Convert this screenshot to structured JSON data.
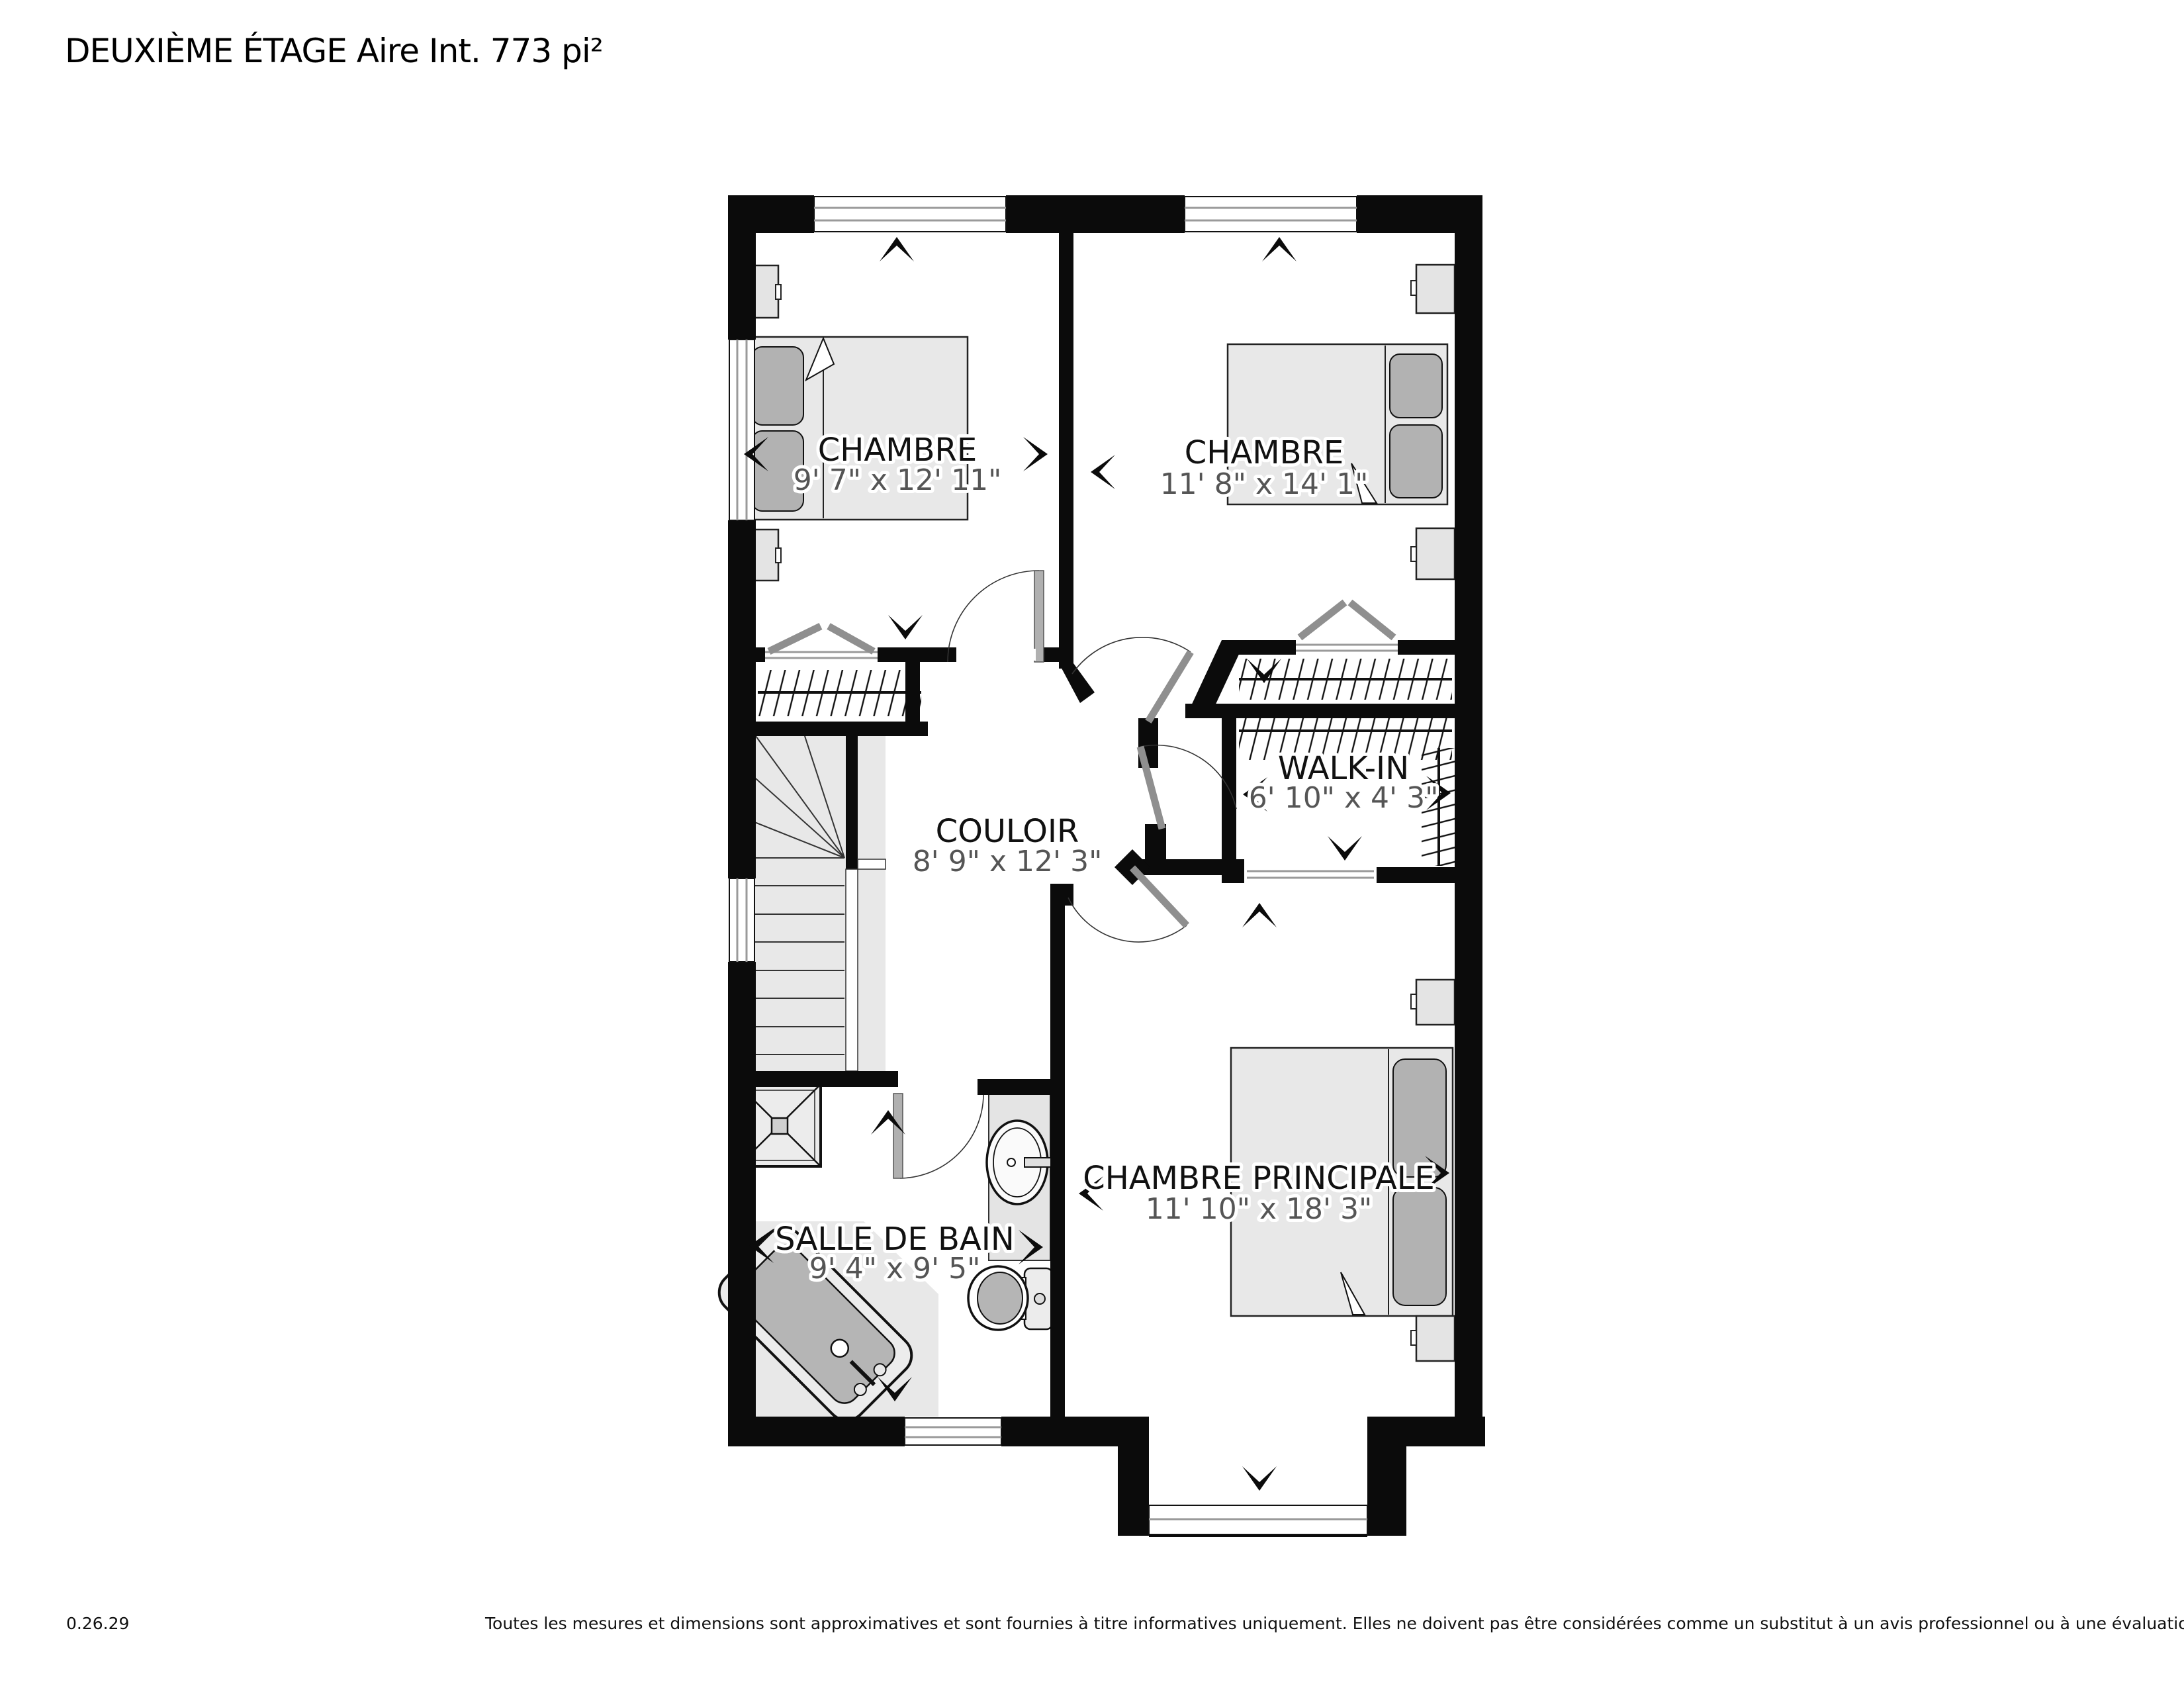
{
  "title": "DEUXIÈME ÉTAGE Aire Int. 773 pi²",
  "rooms": [
    {
      "id": "bedroom-1",
      "name": "CHAMBRE",
      "dims": "9' 7\" x 12' 11\""
    },
    {
      "id": "bedroom-2",
      "name": "CHAMBRE",
      "dims": "11' 8\" x 14' 1\""
    },
    {
      "id": "walk-in",
      "name": "WALK-IN",
      "dims": "6' 10\" x 4' 3\""
    },
    {
      "id": "couloir",
      "name": "COULOIR",
      "dims": "8' 9\" x 12' 3\""
    },
    {
      "id": "master-bedroom",
      "name": "CHAMBRE PRINCIPALE",
      "dims": "11' 10\" x 18' 3\""
    },
    {
      "id": "bathroom",
      "name": "SALLE DE BAIN",
      "dims": "9' 4\" x 9' 5\""
    }
  ],
  "footer": {
    "version": "0.26.29",
    "disclaimer": "Toutes les mesures et dimensions sont approximatives et sont fournies à titre informatives uniquement. Elles ne doivent pas être considérées comme un substitut à un avis professionnel ou à une évaluation précise."
  },
  "colors": {
    "wall": "#0b0b0b",
    "floor": "#ffffff",
    "furniture": "#e8e8e8",
    "accent_gray": "#b2b2b2",
    "dims_text": "#555555"
  }
}
